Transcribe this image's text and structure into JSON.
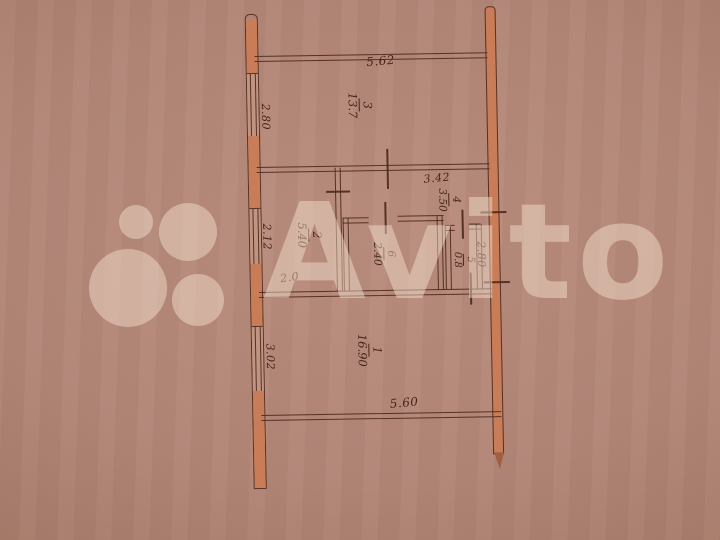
{
  "watermark": {
    "brand": "Avito"
  },
  "plan": {
    "rooms": {
      "r1": {
        "number": "1",
        "area": "16.90"
      },
      "r2": {
        "number": "2",
        "area": "5.40"
      },
      "r3": {
        "number": "3",
        "area": "13.7"
      },
      "r4": {
        "number": "4",
        "area": "3.50"
      },
      "r5": {
        "number": "5",
        "area": "0.8"
      },
      "r6": {
        "number": "6",
        "area": "2.40"
      }
    },
    "dimensions": {
      "top": "5.62",
      "middle": "3.42",
      "corridor": "2.0",
      "bottom": "5.60",
      "left_upper": "2.80",
      "left_middle": "2.12",
      "left_lower": "3.02",
      "right": "2.80"
    },
    "colors": {
      "ink": "#47241a",
      "wall_fill": "#c87c57"
    }
  }
}
